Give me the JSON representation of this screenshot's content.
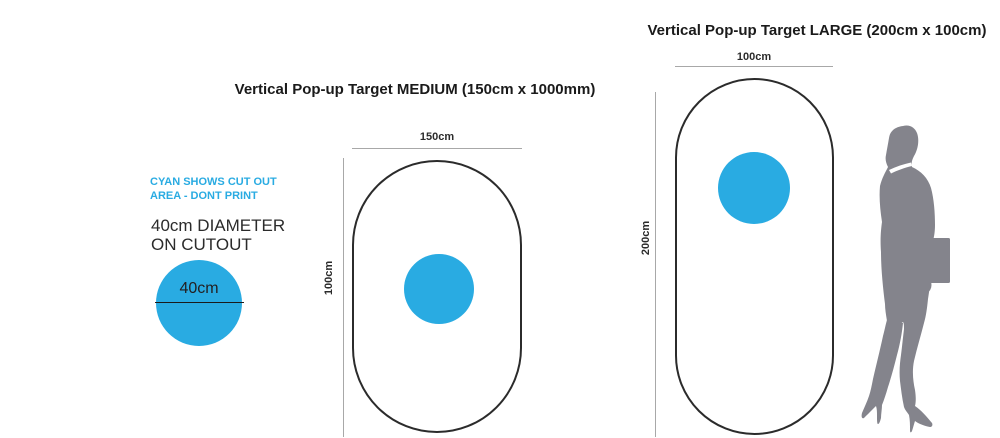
{
  "colors": {
    "cyan": "#29ABE2",
    "outline": "#2B2B2B",
    "dimension_line": "#A8A8A8",
    "silhouette": "#84848C",
    "text": "#231F20"
  },
  "annotations": {
    "note_line1": "CYAN SHOWS CUT OUT",
    "note_line2": "AREA - DONT PRINT",
    "spec_line1": "40cm DIAMETER",
    "spec_line2": "ON CUTOUT",
    "sample_circle_label": "40cm"
  },
  "medium_target": {
    "title": "Vertical Pop-up Target MEDIUM (150cm x 1000mm)",
    "width_label": "150cm",
    "height_label": "100cm"
  },
  "large_target": {
    "title": "Vertical Pop-up Target LARGE (200cm x 100cm)",
    "width_label": "100cm",
    "height_label": "200cm"
  },
  "figure": {
    "icon": "person-silhouette"
  }
}
